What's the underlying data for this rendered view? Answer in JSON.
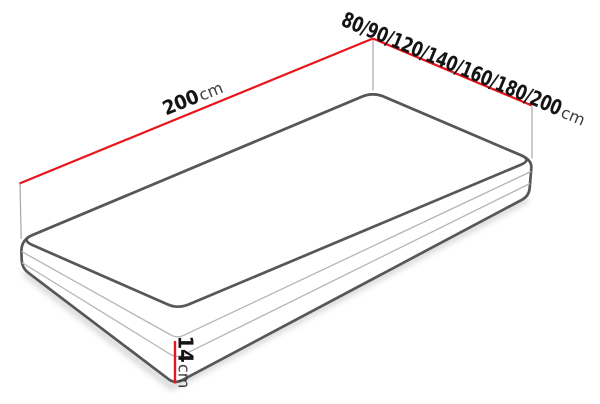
{
  "diagram": {
    "length_label": {
      "value": "200",
      "unit": "cm"
    },
    "width_label": {
      "value": "80/90/120/140/160/180/200",
      "unit": "cm"
    },
    "height_label": {
      "value": "14",
      "unit": "cm"
    },
    "colors": {
      "dimension_line": "#e8151b",
      "edge": "#56575a",
      "seam": "#b4b5b7",
      "extension": "#a5a6a8",
      "label_value": "#141414",
      "label_unit": "#3d3d3d",
      "background": "#ffffff"
    }
  }
}
